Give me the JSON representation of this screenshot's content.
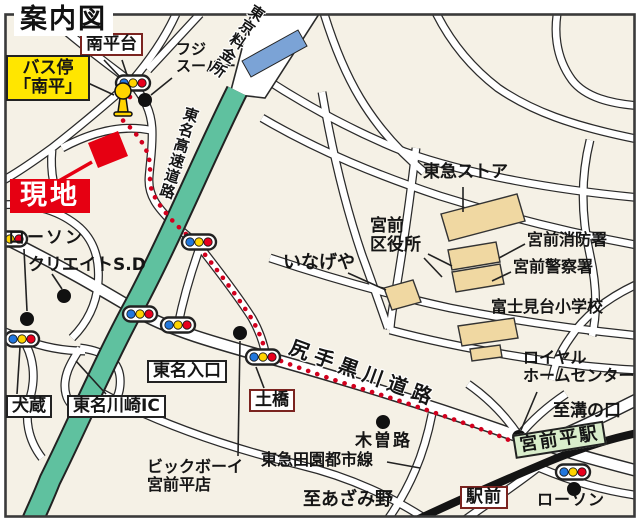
{
  "title": "案内図",
  "colors": {
    "map_background": "#f5f1e6",
    "expressway_green": "#5fc19f",
    "tollgate_blue": "#7ba3d6",
    "route_red": "#d2001e",
    "site_red": "#e60012",
    "building_tan": "#f0d8a2",
    "bus_label_yellow": "#ffe600",
    "station_green": "#d9edcb",
    "label_border_maroon": "#7b2420",
    "railway_black": "#141414"
  },
  "icons": {
    "traffic_light": "traffic-light-icon",
    "bus_stop_sign": "bus-stop-icon",
    "landmark_dot": "landmark-dot-icon",
    "tollgate_bar": "tollgate-icon"
  },
  "labels": {
    "minamidaira_heights": "南平台",
    "bus_stop": {
      "line1": "バス停",
      "line2": "「南平」"
    },
    "fuji_super": {
      "line1": "フジ",
      "line2": "スーパー"
    },
    "tokyo_tollgate": "東京料金所",
    "tomei_expressway": "東名高速道路",
    "site": "現地",
    "lawson_north": "ローソン",
    "create_sd": "クリエイトS.D",
    "tokyu_store": "東急ストア",
    "ward_office": {
      "line1": "宮前",
      "line2": "区役所"
    },
    "inageya": "いなげや",
    "fire_station": "宮前消防署",
    "police_station": "宮前警察署",
    "fujimidai_elementary": "富士見台小学校",
    "shitte_kurokawa_road": "尻手黒川道路",
    "tomei_entrance": "東名入口",
    "dobashi": "土橋",
    "royal_home_center": {
      "line1": "ロイヤル",
      "line2": "ホームセンター"
    },
    "to_mizonokuchi": "至溝の口",
    "inukura": "犬蔵",
    "tomei_kawasaki_ic": "東名川崎IC",
    "kisoji": "木曽路",
    "big_boy": {
      "line1": "ビックボーイ",
      "line2": "宮前平店"
    },
    "denentoshi_line": "東急田園都市線",
    "miyamaedaira_station": "宮前平駅",
    "to_azamino": "至あざみ野",
    "ekimae": "駅前",
    "lawson_south": "ローソン"
  }
}
